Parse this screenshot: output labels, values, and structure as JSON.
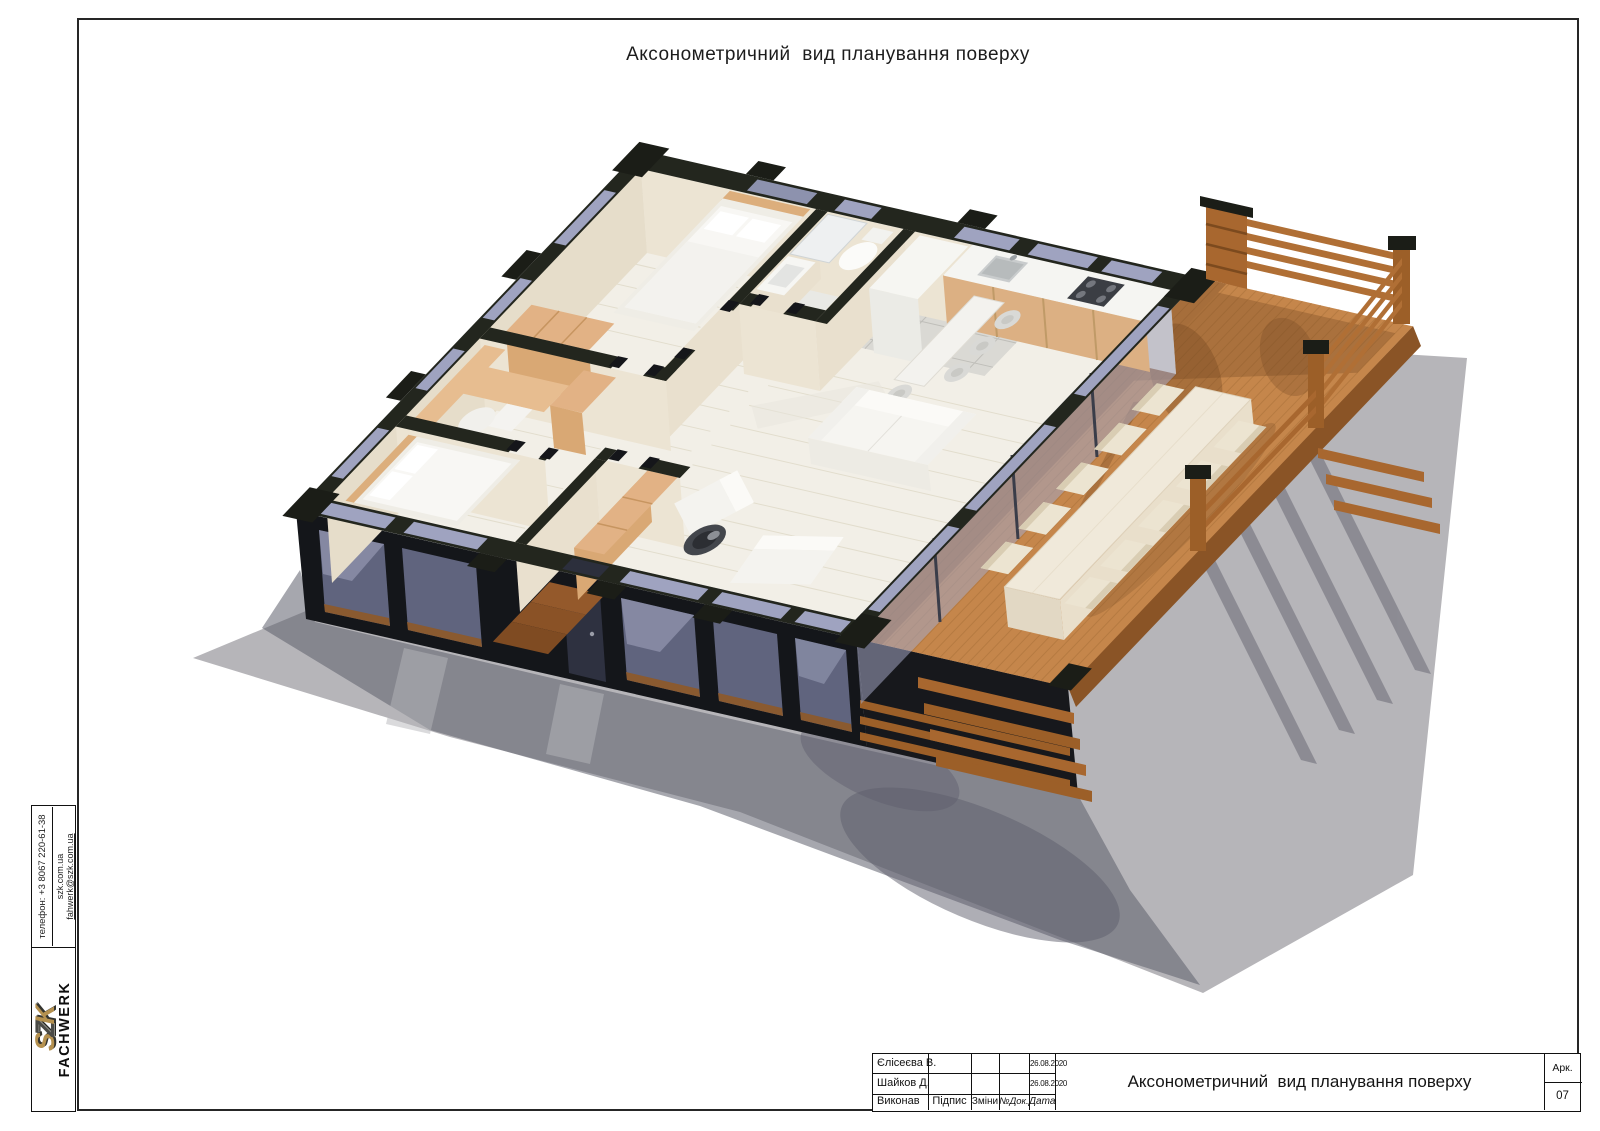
{
  "sheet": {
    "title": "Аксонометричний  вид планування поверху"
  },
  "stamp": {
    "title": "Аксонометричний  вид планування поверху",
    "rows": [
      {
        "name": "Єлісеєва В.",
        "date": "26.08.2020"
      },
      {
        "name": "Шайков Д.",
        "date": "26.08.2020"
      }
    ],
    "labels": {
      "executed": "Виконав",
      "signature": "Підпис",
      "changes": "Зміни",
      "doc_no": "№Док.",
      "date": "Дата"
    },
    "sheet_label": "Арк.",
    "sheet_number": "07"
  },
  "branding": {
    "logo_letters": [
      "S",
      "Z",
      "K"
    ],
    "logo_secondary": "FACHWERK",
    "phone": "телефон: +3 8067 220-61-38",
    "website": "szk.com.ua",
    "email": "fahwerk@szk.com.ua"
  },
  "palette": {
    "wall_dark": "#22251e",
    "interior_wall_cream": "#ece4d3",
    "floor_light": "#f2efe7",
    "deck_wood": "#c5864b",
    "railing_wood": "#a8672f",
    "furniture_wood": "#e2b285",
    "glass_tint": "#9fa3c0",
    "ground_gray": "#b6b5b9",
    "shadow_gray": "#5d5e6c",
    "logo_gold": "#b5914f"
  }
}
